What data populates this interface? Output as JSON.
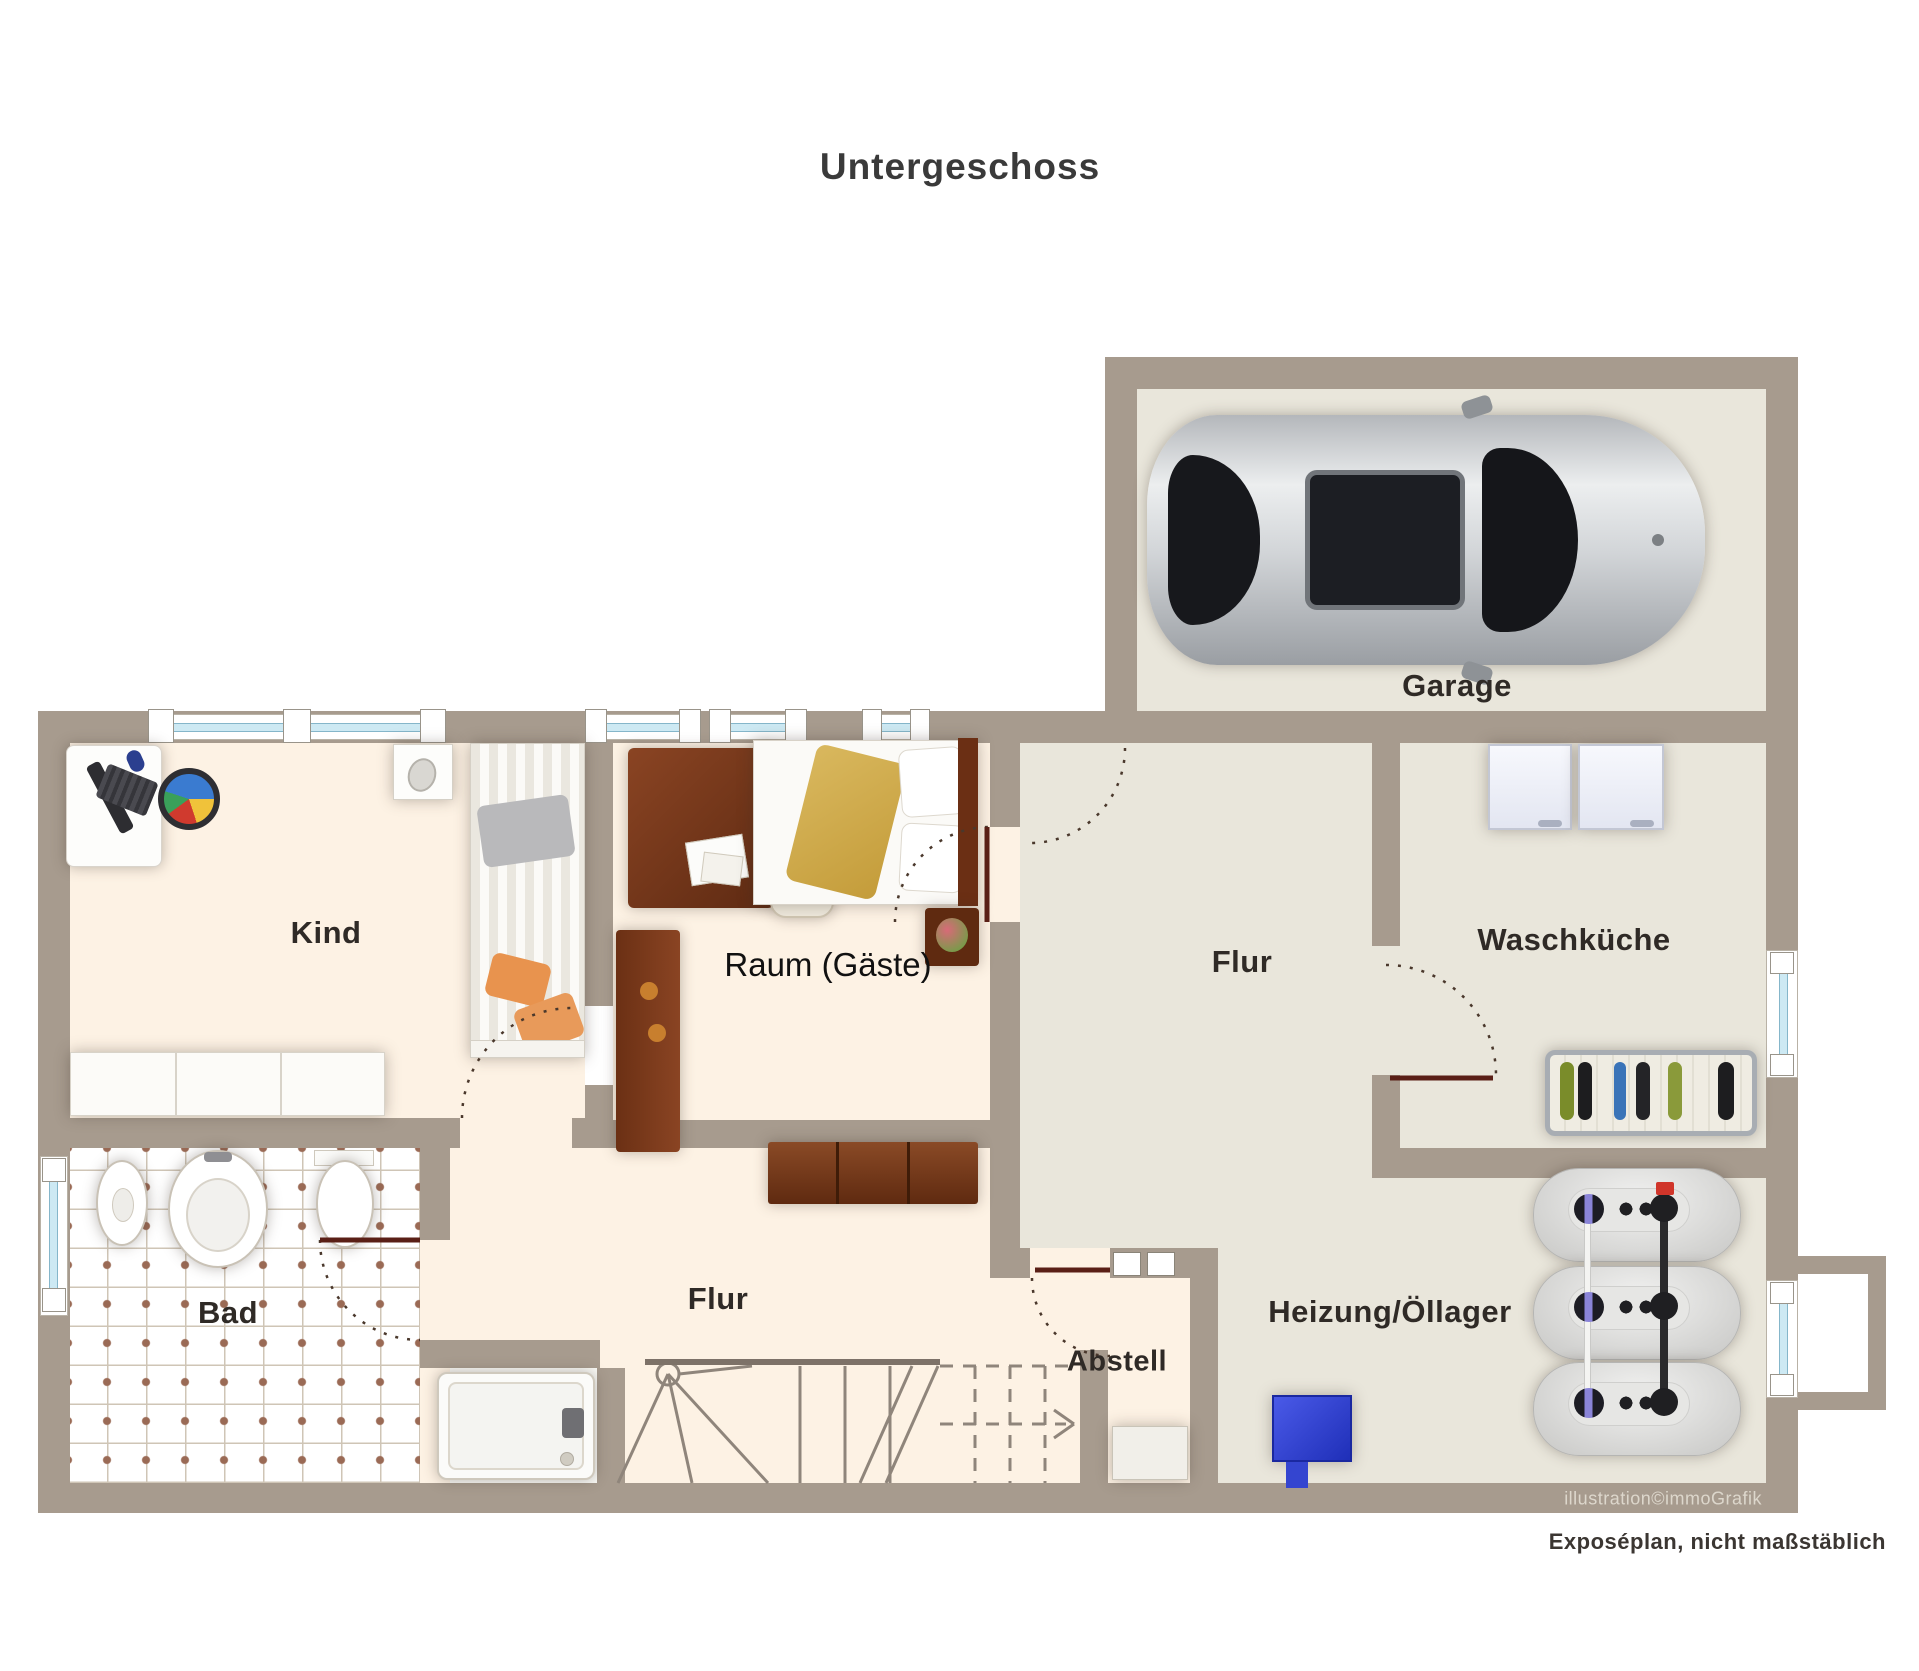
{
  "title": "Untergeschoss",
  "rooms": {
    "garage": "Garage",
    "kind": "Kind",
    "raum_gaeste": "Raum (Gäste)",
    "flur_upper": "Flur",
    "waschkueche": "Waschküche",
    "bad": "Bad",
    "flur_lower": "Flur",
    "abstell": "Abstell",
    "heizung_oellager": "Heizung/Öllager"
  },
  "footer": {
    "credit": "illustration©immoGrafik",
    "disclaimer": "Exposéplan, nicht maßstäblich"
  },
  "colors": {
    "wall": "#a79b8e",
    "floor_cream": "#fdf2e4",
    "floor_grey": "#e9e6db",
    "window_glass": "#cde9f3",
    "door_leaf": "#5a1f16",
    "heater_blue": "#2b3ed8",
    "pillow_orange": "#e8934e",
    "duvet_gold": "#d4af52"
  }
}
